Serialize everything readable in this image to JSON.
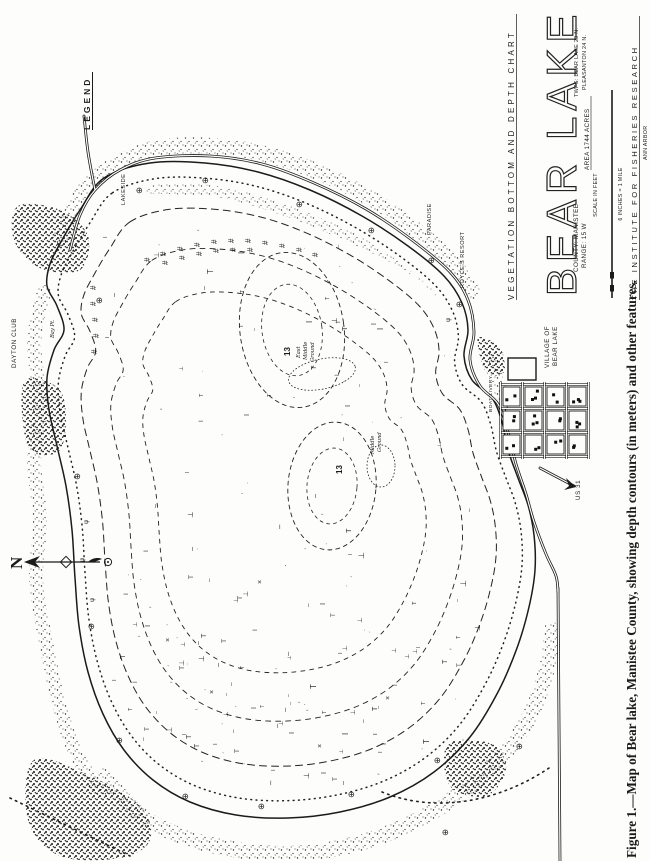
{
  "figure": {
    "caption": "Figure 1.—Map of Bear lake, Manistee County, showing depth contours (in meters) and other features."
  },
  "legend": {
    "title": "LEGEND",
    "items": [
      {
        "symbol": "∴",
        "label": "GRAVEL"
      },
      {
        "symbol": "∵",
        "label": "ROCKS"
      },
      {
        "symbol": "∴·",
        "label": "SPAWNING BEDS"
      },
      {
        "symbol": "×",
        "label": "TRASH"
      },
      {
        "symbol": "⊕",
        "label": "VEGETATION EXAMINATION"
      },
      {
        "symbol": "I",
        "label": "EMERGENT VEG."
      },
      {
        "symbol": "T",
        "label": "FLOATING VEG."
      },
      {
        "symbol": "—",
        "label": "SUBMERGENT VEG."
      },
      {
        "symbol": "⊥",
        "label": "BOTTOM VEG."
      },
      {
        "symbol": "∕",
        "label": "DROP - OFF"
      },
      {
        "symbol": "∕",
        "label": "DEPTH CONTOUR (M)"
      },
      {
        "symbol": "ψ",
        "label": "MARSHY"
      },
      {
        "symbol": "◎",
        "label": "BRUSH"
      },
      {
        "symbol": "⊙",
        "label": "CLEARED LAND"
      },
      {
        "symbol": "∗",
        "label": "WOODED"
      },
      {
        "symbol": "∼",
        "label": "HIGH GROUND"
      },
      {
        "symbol": "#",
        "label": "BRUSH SHELTER"
      }
    ],
    "notes": [
      "# 26 BRUSH SHELTERS INSTALLED",
      "IN SPRING OF 1946."
    ],
    "depth_note": [
      "LAKE DEPTHS SHOWN",
      "IN METERS"
    ]
  },
  "title_block": {
    "chart_type": "VEGETATION  BOTTOM  AND  DEPTH  CHART",
    "lake_name": "BEAR LAKE",
    "area": "AREA 1744 ACRES",
    "county": "COUNTY: MANISTEE",
    "range": "RANGE: 15 W",
    "townships": [
      "TWPS: BEAR LAKE 23 N.",
      "PLEASANTON 24 N."
    ],
    "scale_label": "SCALE IN FEET",
    "scale_ticks": [
      "0",
      "500",
      "1000",
      "2000",
      "3000",
      "4000"
    ],
    "scale_note": "6 INCHES = 1 MILE",
    "institute": "THE  INSTITUTE  FOR  FISHERIES  RESEARCH",
    "institute_city": "ANN ARBOR"
  },
  "map": {
    "north_label": "N",
    "depth_labels": [
      "13",
      "13"
    ],
    "place_labels": {
      "village_line1": "VILLAGE OF",
      "village_line2": "BEAR LAKE",
      "dayton_club": "DAYTON CLUB",
      "lakeside": "LAKESIDE",
      "paradise": "PARADISE",
      "royces_resort": "ROYCE'S RESORT",
      "boat_livery": "BOAT LIVERY",
      "bay_pt": "Bay Pt.",
      "highway": "US 31",
      "shoal_upper": [
        "East",
        "Middle",
        "Ground"
      ],
      "shoal_lower": [
        "Middle",
        "Ground"
      ]
    },
    "symbols": {
      "brush_shelter": "#",
      "veg_exam": "⊕",
      "trash": "×",
      "floating": "T",
      "emergent": "I",
      "bottom": "⊥",
      "submergent": "–",
      "marsh": "ψ",
      "tick": "ʼ"
    }
  }
}
